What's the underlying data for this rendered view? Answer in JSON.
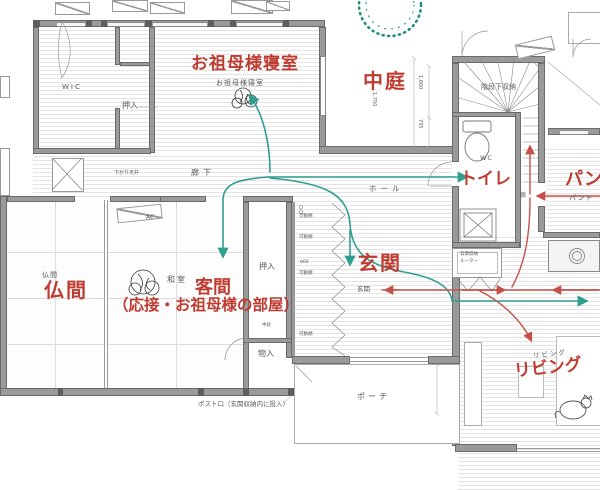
{
  "colors": {
    "red_label": "#bf3b2f",
    "teal_flow": "#2f9e8e",
    "red_flow": "#c65048",
    "wall": "#9a9a9a",
    "hatch_line": "#e4e4e4"
  },
  "labels": {
    "red": {
      "bedroom": "お祖母様寝室",
      "courtyard": "中庭",
      "toilet": "トイレ",
      "pantry": "パン",
      "butsuma": "仏間",
      "guest1": "客間",
      "guest2": "（応接・お祖母様の部屋）",
      "entrance": "玄関",
      "living": "リビング"
    },
    "small": {
      "wic": "WIC",
      "oshiire": "押入",
      "bedroom": "お祖母様寝室",
      "corridor": "廊下",
      "lowered_ceiling": "下がり天井",
      "hall": "ホール",
      "under_stairs": "階段下収納",
      "wc": "WC",
      "entrance": "玄関",
      "porch": "ポーチ",
      "monoire": "物入",
      "washitsu": "和室",
      "butsuma": "仏間",
      "shelf": "可動棚",
      "ac": "AC",
      "post": "ポスト口（玄関収納内に投入）",
      "storage": "玄関収納",
      "router": "ルーター",
      "chudan": "中段",
      "living": "リビング",
      "pantry": "パント",
      "rou": "廊"
    },
    "dims": {
      "d1": "1,800",
      "d2": "1,750",
      "d3": "735",
      "shelf": "660"
    }
  }
}
